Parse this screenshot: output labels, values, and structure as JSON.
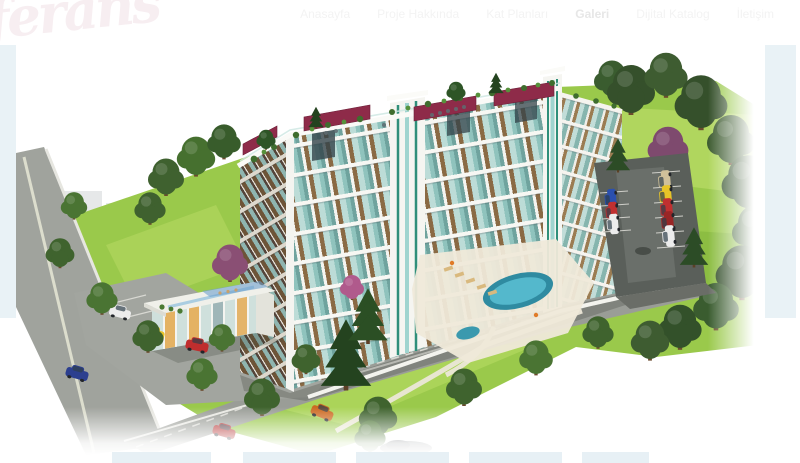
{
  "brand": {
    "logo_text": "ferans"
  },
  "nav": {
    "items": [
      {
        "label": "Anasayfa",
        "active": false
      },
      {
        "label": "Proje Hakkında",
        "active": false
      },
      {
        "label": "Kat Planları",
        "active": false
      },
      {
        "label": "Galeri",
        "active": true
      },
      {
        "label": "Dijital Katalog",
        "active": false
      },
      {
        "label": "İletişim",
        "active": false
      }
    ]
  },
  "hero": {
    "image_alt": "Aerial 3D architectural rendering of an 8-storey residential block with rooftop terraces and maroon pergolas, landscaped gardens, swimming pool, two-storey social facility building, parking lots with cars, roads and trees",
    "panel_color": "#e9f2f6"
  },
  "gallery": {
    "thumbnail_count": 5
  },
  "colors": {
    "canopy_maroon": "#8e2b49",
    "facade_teal": "#8fc3bd",
    "facade_wood": "#8a6a44",
    "tower_green": "#2f8f7a",
    "lawn_green": "#8fc045",
    "pool_blue": "#3e9fb5",
    "panel_blue": "#e9f2f6",
    "asphalt_gray": "#9a9d97"
  }
}
